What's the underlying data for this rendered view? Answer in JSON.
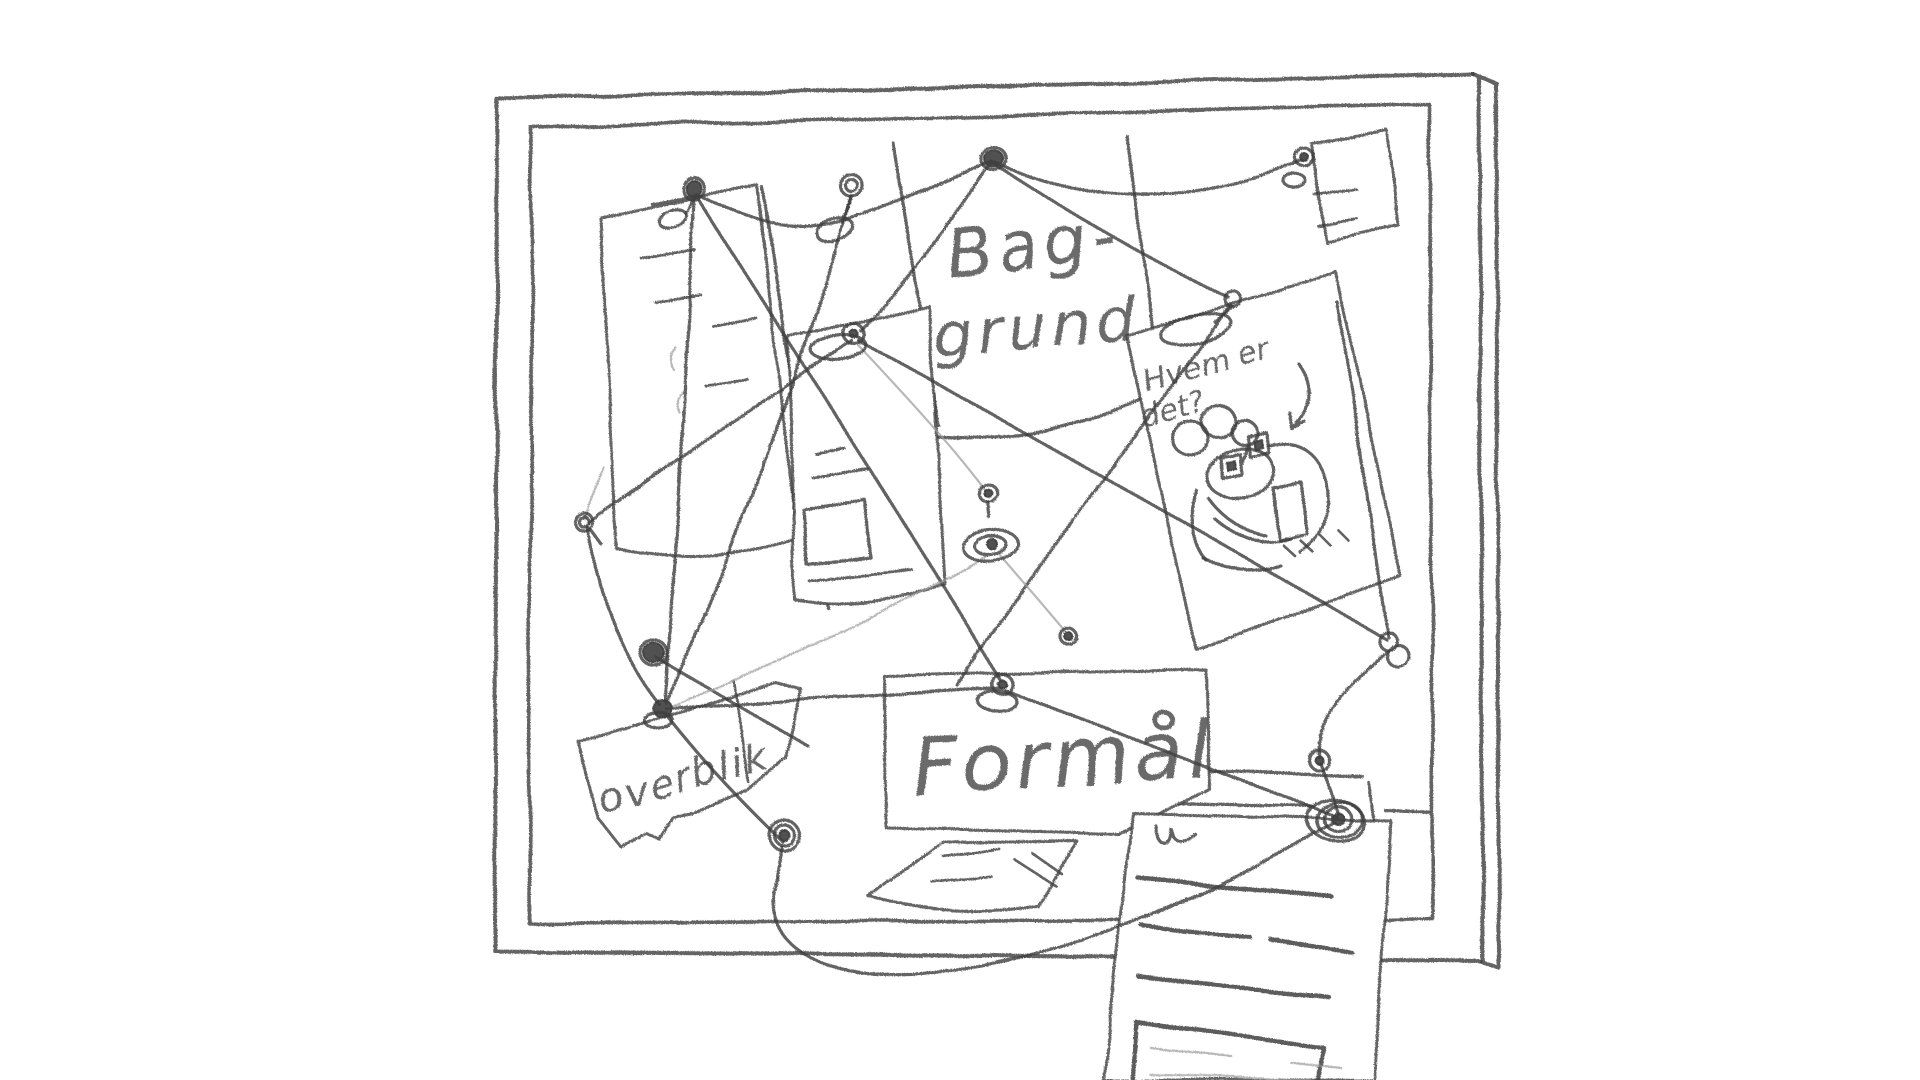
{
  "board": {
    "labels": {
      "baggrund_line1": "Bag-",
      "baggrund_line2": "grund",
      "portrait_question_line1": "Hvem er",
      "portrait_question_line2": "det?",
      "overblik": "overblik",
      "formaal": "Formål"
    },
    "colors": {
      "pencil_dark": "#3f3f3f",
      "pencil_mid": "#555555",
      "pencil_light": "#9a9a9a",
      "paper": "#ffffff"
    }
  }
}
